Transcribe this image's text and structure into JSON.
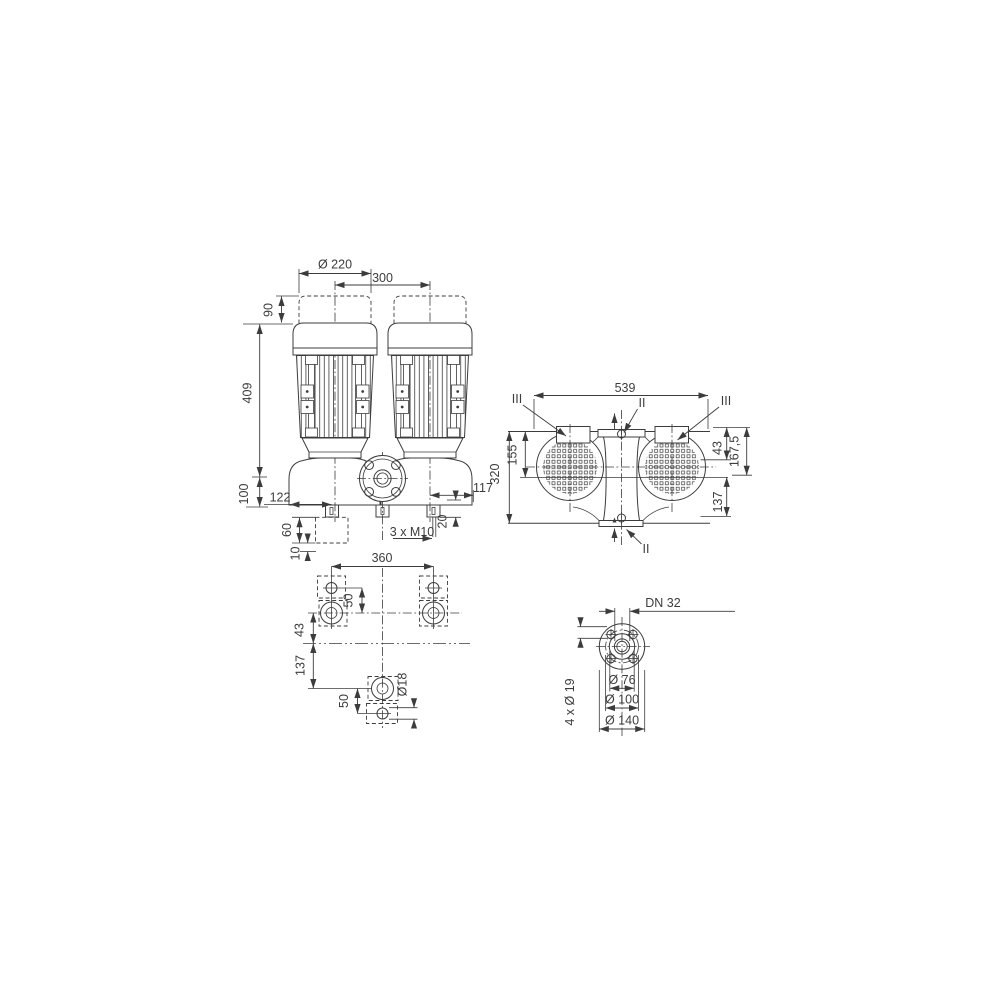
{
  "drawing": {
    "background": "#ffffff",
    "line_color": "#3c3c3c",
    "views": {
      "front": {
        "dims": {
          "fan_dia": "Ø 220",
          "spacing": "300",
          "clearance": "90",
          "height": "409",
          "axis_height": "100",
          "foot_left": "122",
          "foot_right": "117",
          "foot_step": "20",
          "tapped": "3 x M10",
          "block": "60",
          "grout": "10"
        }
      },
      "plan": {
        "dims": {
          "length": "539",
          "width": "320",
          "axis": "155",
          "d43": "43",
          "d167": "167,5",
          "d137": "137"
        },
        "sections": {
          "left": "III",
          "right": "III",
          "top": "II",
          "bottom": "II"
        }
      },
      "foundation": {
        "dims": {
          "span": "360",
          "top_offset": "50",
          "d43": "43",
          "d137": "137",
          "bottom_offset": "50",
          "hole": "Ø18"
        }
      },
      "flange": {
        "dims": {
          "dn": "DN 32",
          "bolts": "4 x Ø 19",
          "face": "Ø 76",
          "bolt_circle": "Ø 100",
          "outer": "Ø 140"
        }
      }
    }
  }
}
